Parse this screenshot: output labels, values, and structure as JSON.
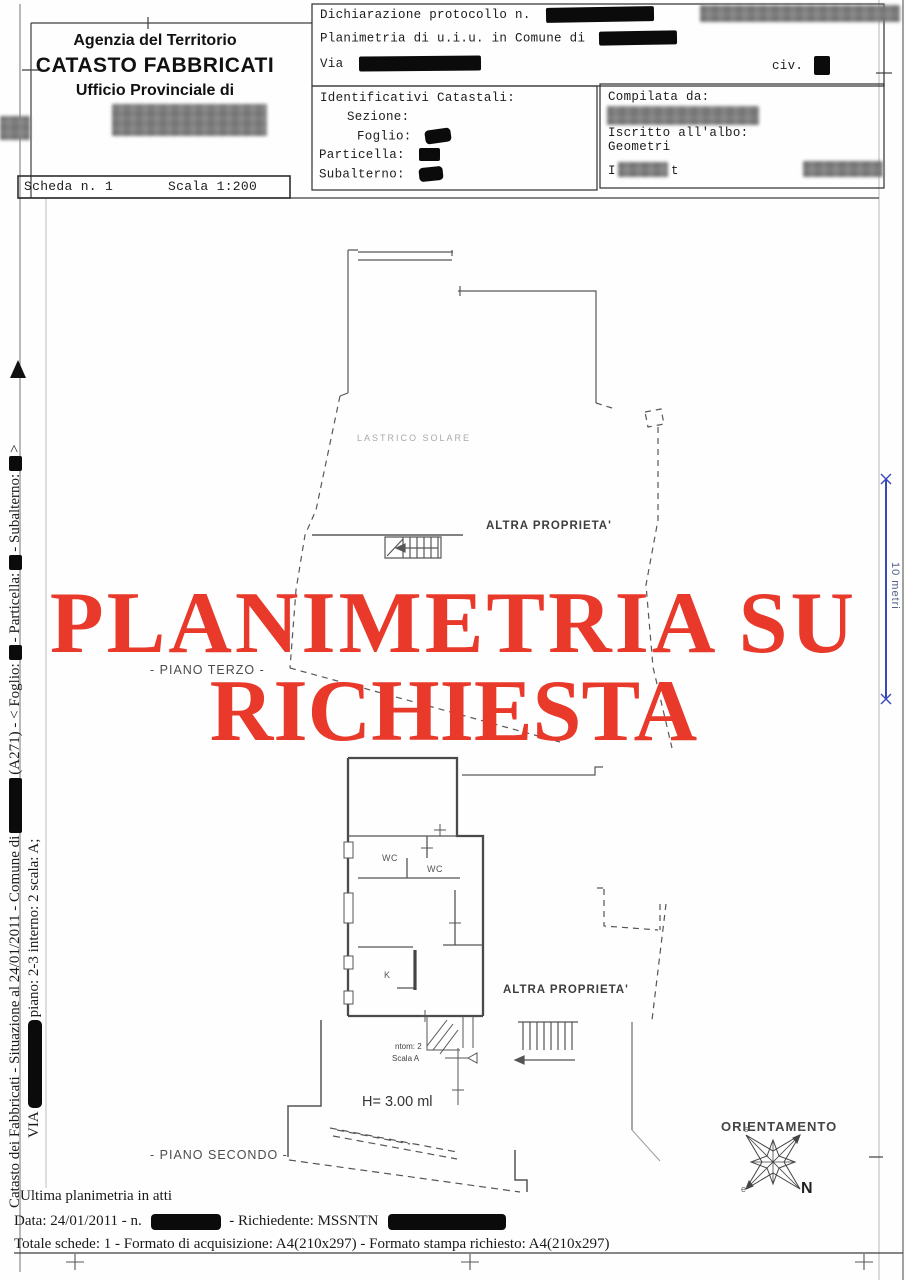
{
  "header": {
    "agency_line1": "Agenzia del Territorio",
    "agency_line2": "CATASTO FABBRICATI",
    "agency_line3": "Ufficio Provinciale di",
    "protocol_label": "Dichiarazione protocollo n.",
    "planimetria_label": "Planimetria di u.i.u. in Comune di",
    "via_label": "Via",
    "civ_label": "civ.",
    "identificativi_title": "Identificativi Catastali:",
    "sezione_label": "Sezione:",
    "foglio_label": "Foglio:",
    "particella_label": "Particella:",
    "subalterno_label": "Subalterno:",
    "compilata_label": "Compilata da:",
    "albo_label": "Iscritto all'albo:",
    "albo_value": "Geometri",
    "firma_left": "I",
    "firma_right": "t",
    "scheda": "Scheda n. 1",
    "scala": "Scala 1:200"
  },
  "watermark": {
    "line1": "PLANIMETRIA SU",
    "line2": "RICHIESTA",
    "color": "#e8392b"
  },
  "plan_labels": {
    "lastrico": "LASTRICO SOLARE",
    "altra_upper": "ALTRA PROPRIETA'",
    "piano_terzo": "- PIANO TERZO -",
    "wc1": "WC",
    "wc2": "WC",
    "kitchen": "K",
    "altra_lower": "ALTRA PROPRIETA'",
    "height_note": "H= 3.00 ml",
    "stair_note1": "ntom: 2",
    "stair_note2": "Scala A",
    "piano_secondo": "- PIANO SECONDO -"
  },
  "orientation": {
    "title": "ORIENTAMENTO",
    "north": "N",
    "pt_s": "s",
    "pt_c": "c",
    "pt_e": "e"
  },
  "scalebar": {
    "label": "10 metri",
    "color": "#3947b8"
  },
  "sidebar": {
    "line1_a": "Catasto dei Fabbricati - Situazione al 24/01/2011 - Comune di",
    "line1_b": "(A271) - < Foglio:",
    "line1_c": "- Particella:",
    "line1_d": "- Subalterno:",
    "line1_e": ">",
    "line2_a": "VIA",
    "line2_b": "piano: 2-3 interno: 2 scala: A;"
  },
  "footer": {
    "line1": "Ultima planimetria in atti",
    "line2_a": "Data: 24/01/2011 - n.",
    "line2_b": "- Richiedente: MSSNTN",
    "line3": "Totale schede: 1 - Formato di acquisizione: A4(210x297)  - Formato stampa richiesto: A4(210x297)"
  }
}
